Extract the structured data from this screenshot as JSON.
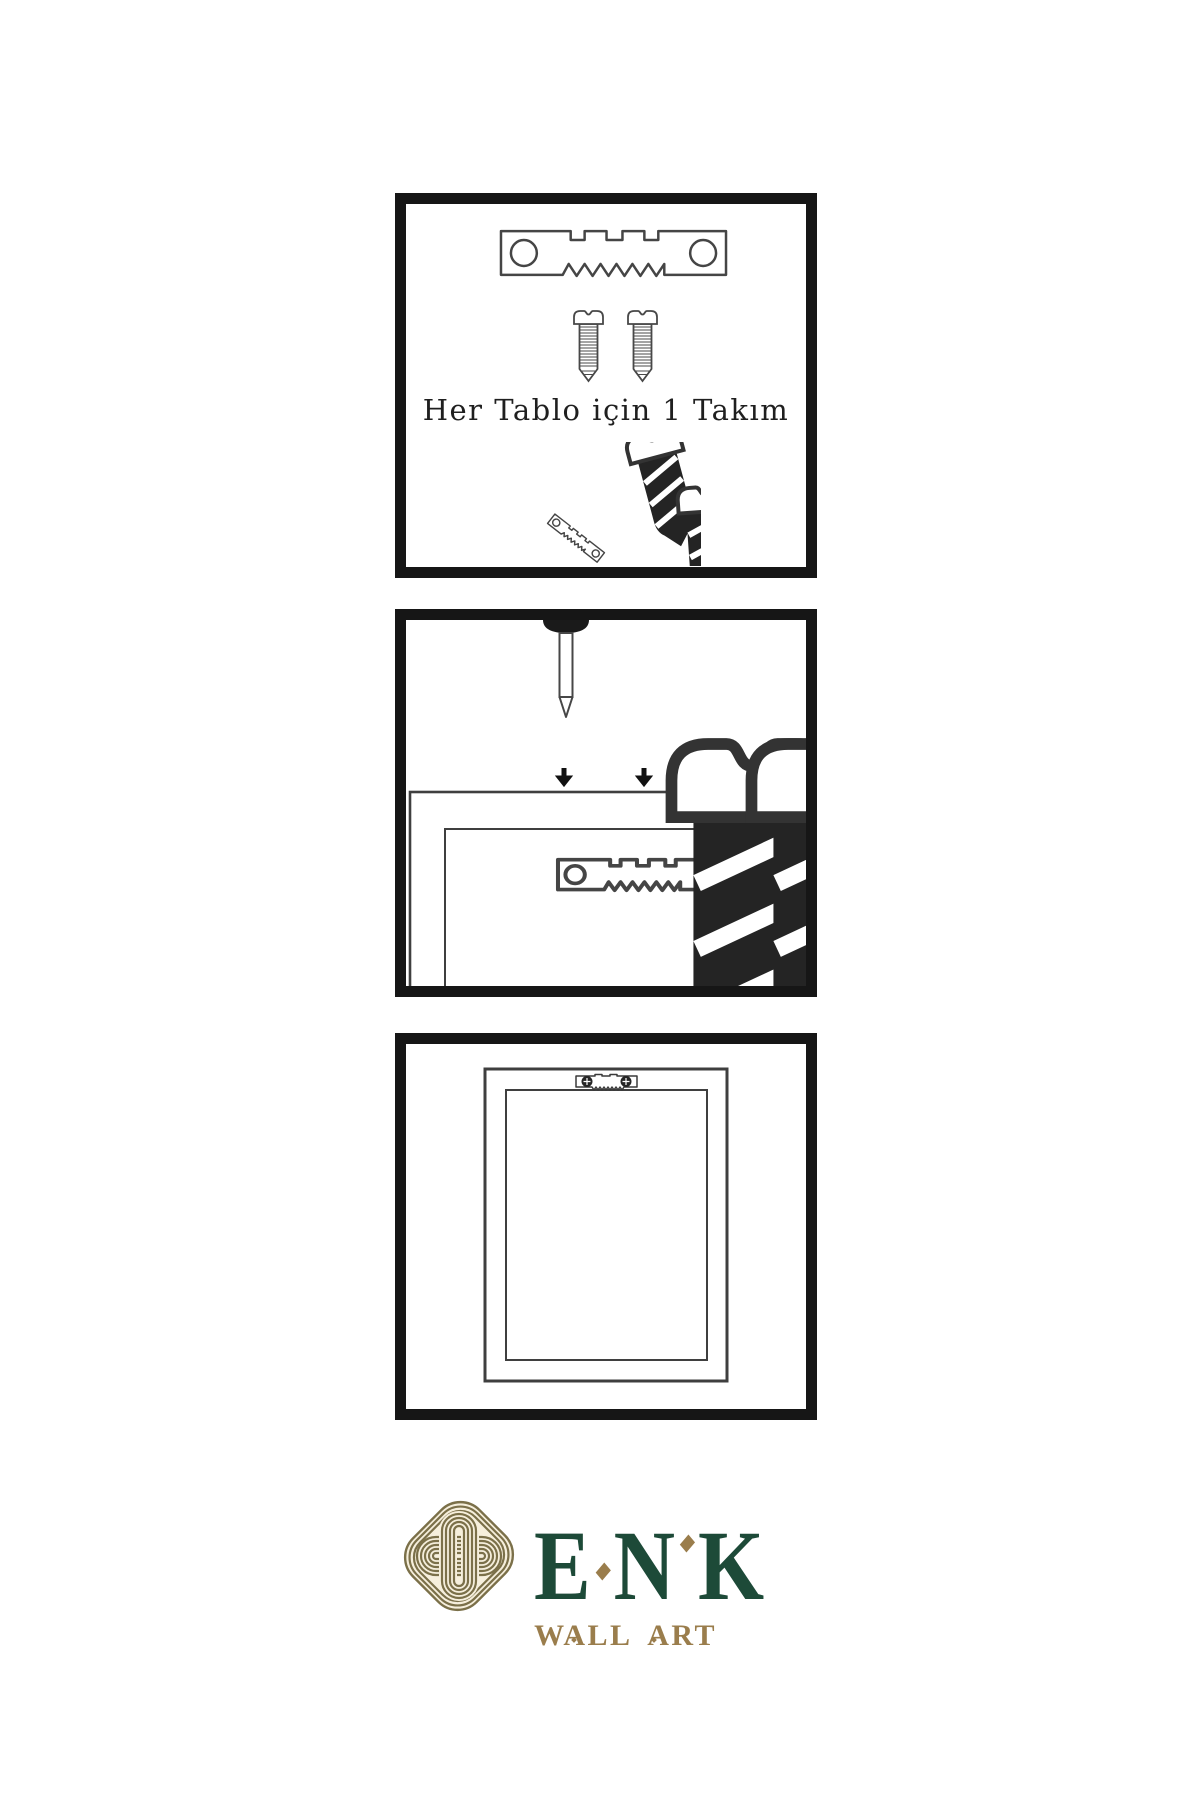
{
  "meta": {
    "language": "tr",
    "kind": "wall-art-hanging-instructions"
  },
  "colors": {
    "panel_border": "#161616",
    "drawing_line": "#454545",
    "dark_fill": "#242424",
    "caption_text": "#1f1f1f",
    "logo_green": "#1d4a38",
    "logo_gold": "#9a7d4c",
    "knot_olive": "#7b7049",
    "knot_cream": "#f6efdc"
  },
  "steps": [
    {
      "name": "hardware-kit",
      "caption": "Her Tablo için 1 Takım",
      "items": [
        "sawtooth-hanger",
        "mounting-screw",
        "mounting-screw",
        "screw-into-hanger-assembly"
      ]
    },
    {
      "name": "attach-hanger-to-frame-back",
      "items": [
        "wall-nail",
        "mounting-screw-with-down-arrow",
        "mounting-screw-with-down-arrow",
        "frame-back-with-sawtooth-hanger"
      ]
    },
    {
      "name": "mounted-frame",
      "items": [
        "frame-back-with-screwed-sawtooth-hanger"
      ]
    }
  ],
  "brand": {
    "name": "ENK",
    "letters": [
      "E",
      "N",
      "K"
    ],
    "tagline": "WALL ART"
  }
}
